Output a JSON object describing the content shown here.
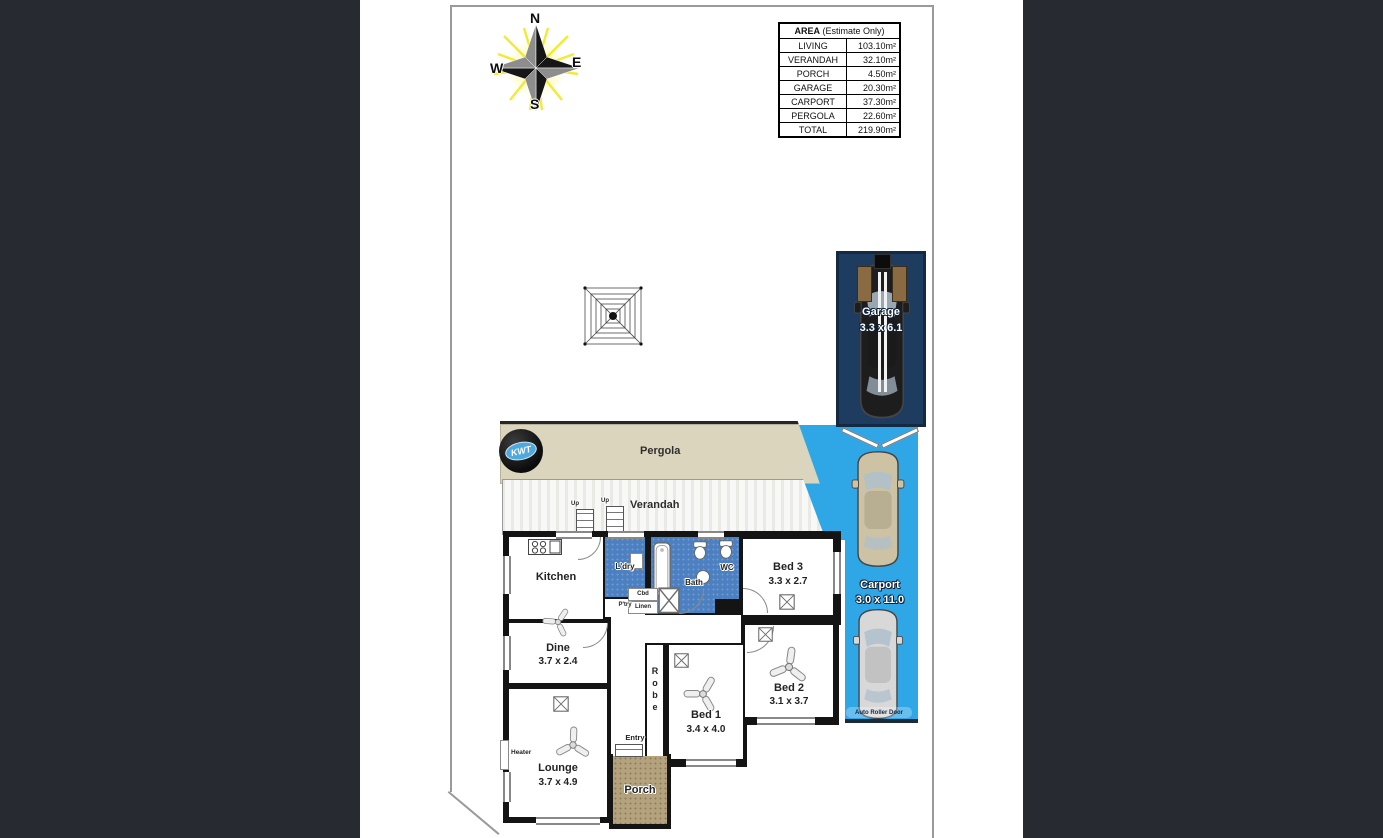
{
  "compass": {
    "n": "N",
    "e": "E",
    "s": "S",
    "w": "W"
  },
  "area_table": {
    "title_bold": "AREA",
    "title_rest": " (Estimate Only)",
    "rows": [
      {
        "label": "LIVING",
        "value": "103.10m²"
      },
      {
        "label": "VERANDAH",
        "value": "32.10m²"
      },
      {
        "label": "PORCH",
        "value": "4.50m²"
      },
      {
        "label": "GARAGE",
        "value": "20.30m²"
      },
      {
        "label": "CARPORT",
        "value": "37.30m²"
      },
      {
        "label": "PERGOLA",
        "value": "22.60m²"
      },
      {
        "label": "TOTAL",
        "value": "219.90m²"
      }
    ]
  },
  "outdoor": {
    "pergola_label": "Pergola",
    "verandah_label": "Verandah",
    "up1": "Up",
    "up2": "Up",
    "garage": {
      "name": "Garage",
      "dims": "3.3 x 6.1"
    },
    "carport": {
      "name": "Carport",
      "dims": "3.0 x 11.0",
      "roller_door": "Auto Roller Door"
    },
    "porch": {
      "name": "Porch"
    }
  },
  "rooms": {
    "kitchen": {
      "name": "Kitchen"
    },
    "ldry": {
      "name": "L'dry"
    },
    "ptry": {
      "name": "P'try"
    },
    "cbd": {
      "name": "Cbd"
    },
    "linen": {
      "name": "Linen"
    },
    "bath": {
      "name": "Bath"
    },
    "wc": {
      "name": "WC"
    },
    "bed3": {
      "name": "Bed 3",
      "dims": "3.3 x 2.7"
    },
    "dine": {
      "name": "Dine",
      "dims": "3.7 x 2.4"
    },
    "bed2": {
      "name": "Bed 2",
      "dims": "3.1 x 3.7"
    },
    "bed1": {
      "name": "Bed 1",
      "dims": "3.4 x 4.0"
    },
    "robe": {
      "name": "Robe"
    },
    "lounge": {
      "name": "Lounge",
      "dims": "3.7 x 4.9"
    },
    "entry": {
      "name": "Entry"
    },
    "heater": {
      "name": "Heater"
    }
  },
  "logo": {
    "text": "KWT"
  },
  "colors": {
    "side_bars": "#272b31",
    "carport_blue": "#2fa6e6",
    "garage_navy": "#1e3c5f",
    "wet_area_blue": "#4d80c0",
    "pergola_beige": "#dcd5bd",
    "porch_tan": "#b3a27d",
    "wall_black": "#141414",
    "compass_ray_yellow": "#f5ef2e"
  }
}
